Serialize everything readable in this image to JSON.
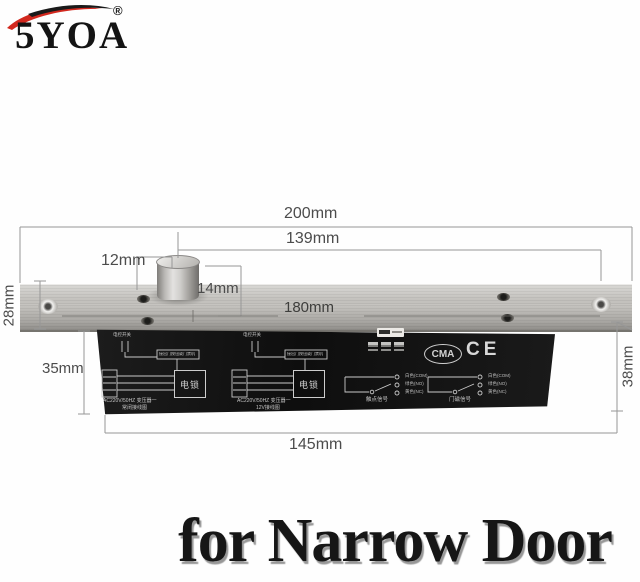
{
  "brand": {
    "name": "5YOA",
    "registered": "®",
    "swoosh_red": "#d2281e"
  },
  "dimensions": {
    "total_width": "200mm",
    "bolt_center_to_end": "139mm",
    "bolt_edge_offset": "12mm",
    "bolt_diameter": "14mm",
    "mounting_hole_spacing": "180mm",
    "plate_depth": "28mm",
    "body_offset": "35mm",
    "body_length": "145mm",
    "body_height": "38mm"
  },
  "device": {
    "certifications": {
      "cma": "CMA",
      "ce": "CE"
    },
    "left_diagram": {
      "switch_label": "电控开关",
      "button_label": "接出门按钮或门禁机",
      "lock_box": "电锁",
      "caption_line1": "AC220V/50HZ 变压器一",
      "caption_line2": "常闭接线图"
    },
    "right_diagram": {
      "switch_label": "电控开关",
      "button_label": "接出门按钮或门禁机",
      "lock_box": "电锁",
      "caption_line1": "AC220V/50HZ 变压器一",
      "caption_line2": "12V接线图"
    },
    "relay_left": {
      "terminals": [
        "白色(COM)",
        "绿色(NO)",
        "黄色(NC)"
      ],
      "caption": "触点信号"
    },
    "relay_right": {
      "terminals": [
        "白色(COM)",
        "绿色(NO)",
        "黄色(NC)"
      ],
      "caption": "门磁信号"
    }
  },
  "footer": {
    "caption": "for Narrow Door",
    "color": "#161616"
  },
  "palette": {
    "metal": "#bdbbb7",
    "body_black": "#151515",
    "dimension_text": "#4c4c4c",
    "background": "#ffffff"
  }
}
